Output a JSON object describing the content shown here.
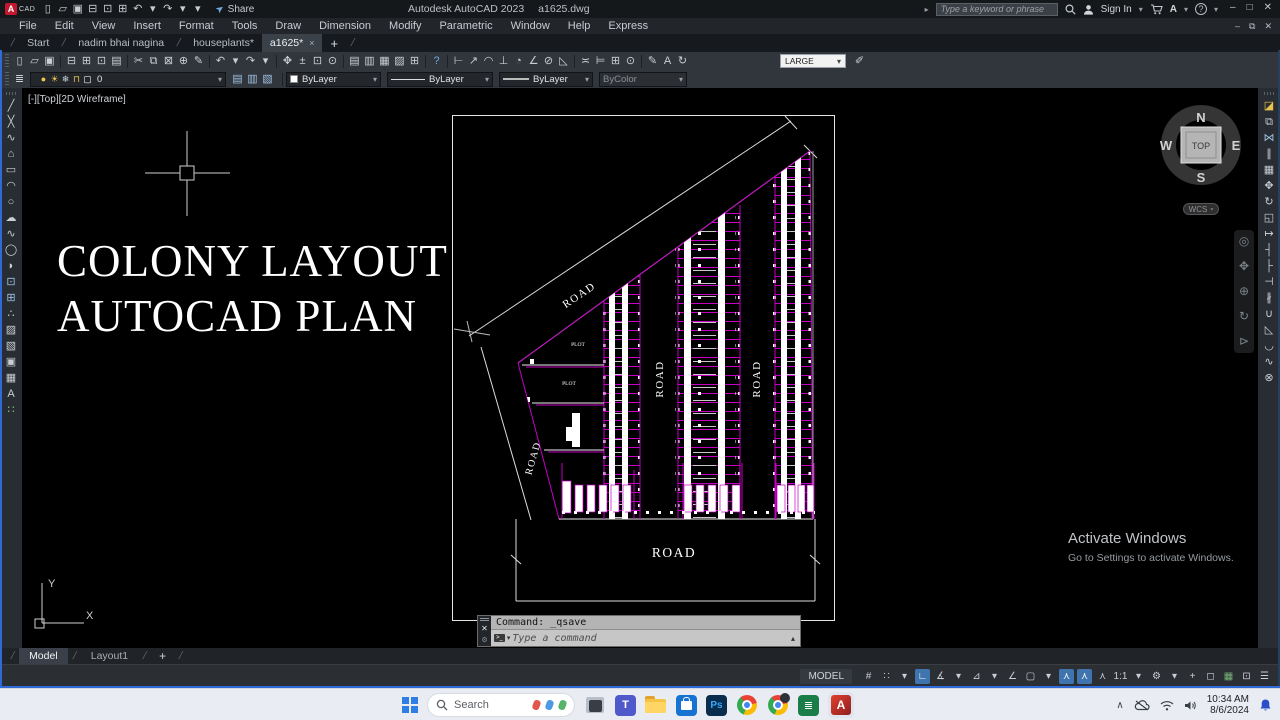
{
  "title_bar": {
    "app_title": "Autodesk AutoCAD 2023",
    "doc_title": "a1625.dwg",
    "share": "Share",
    "search_placeholder": "Type a keyword or phrase",
    "sign_in": "Sign In",
    "store_initial": "A"
  },
  "menu_bar": {
    "items": [
      "File",
      "Edit",
      "View",
      "Insert",
      "Format",
      "Tools",
      "Draw",
      "Dimension",
      "Modify",
      "Parametric",
      "Window",
      "Help",
      "Express"
    ]
  },
  "doc_tabs": {
    "tabs": [
      "Start",
      "nadim bhai nagina",
      "houseplants*",
      "a1625*"
    ],
    "close": "×",
    "add": "+"
  },
  "toolbar1": {
    "dim_style": "LARGE"
  },
  "toolbar2": {
    "layer_name": "0",
    "color": "ByLayer",
    "linetype": "ByLayer",
    "lineweight": "ByLayer",
    "plot_style": "ByColor"
  },
  "viewport_label": "[-][Top][2D Wireframe]",
  "headline": {
    "line1": "COLONY LAYOUT",
    "line2": "AUTOCAD PLAN"
  },
  "plan": {
    "road": "ROAD",
    "plot": "PLOT"
  },
  "viewcube": {
    "n": "N",
    "e": "E",
    "s": "S",
    "w": "W",
    "top": "TOP",
    "wcs": "WCS"
  },
  "ucs": {
    "x": "X",
    "y": "Y"
  },
  "command_line": {
    "history": "Command: _qsave",
    "placeholder": "Type a command"
  },
  "layout_tabs": {
    "model": "Model",
    "layout1": "Layout1",
    "add": "+"
  },
  "status_bar": {
    "model": "MODEL"
  },
  "activate": {
    "line1": "Activate Windows",
    "line2": "Go to Settings to activate Windows."
  },
  "taskbar": {
    "search": "Search",
    "time": "10:34 AM",
    "date": "8/6/2024"
  },
  "glyphs": {
    "chevron_down": "▾",
    "caret_up": "▴",
    "expander": "▸",
    "minimize": "–",
    "maximize": "□",
    "restore": "⧉",
    "close": "✕",
    "slash": "/",
    "prompt": ">_",
    "gear": "⚙",
    "question": "?",
    "help_label": "A",
    "plane": "➤",
    "chevron_up": "∧",
    "ps": "Ps",
    "teams_t": "T",
    "sheet": "≣",
    "cad": "CAD",
    "a_letter": "A",
    "dim_style_icon": "✐"
  },
  "strips": {
    "qat": [
      {
        "n": "new-file",
        "g": "▯"
      },
      {
        "n": "open-file",
        "g": "▱"
      },
      {
        "n": "save-file",
        "g": "▣"
      },
      {
        "n": "plot",
        "g": "⊟"
      },
      {
        "n": "print",
        "g": "⊡"
      },
      {
        "n": "publish",
        "g": "⊞"
      },
      {
        "n": "undo",
        "g": "↶"
      },
      {
        "n": "undo-menu",
        "g": "▾"
      },
      {
        "n": "redo",
        "g": "↷"
      },
      {
        "n": "redo-menu",
        "g": "▾"
      },
      {
        "n": "qat-customize",
        "g": "▾"
      }
    ],
    "toolbar_main": [
      {
        "n": "new-file",
        "g": "▯"
      },
      {
        "n": "open-file",
        "g": "▱"
      },
      {
        "n": "save-file",
        "g": "▣"
      },
      {
        "sep": true
      },
      {
        "n": "plot",
        "g": "⊟"
      },
      {
        "n": "plot-preview",
        "g": "⊞"
      },
      {
        "n": "print",
        "g": "⊡"
      },
      {
        "n": "publish",
        "g": "▤"
      },
      {
        "sep": true
      },
      {
        "n": "cut-clip",
        "g": "✂"
      },
      {
        "n": "copy-clip",
        "g": "⧉"
      },
      {
        "n": "paste-clip",
        "g": "⊠"
      },
      {
        "n": "copy-base-point",
        "g": "⊕"
      },
      {
        "n": "match-properties",
        "g": "✎"
      },
      {
        "sep": true
      },
      {
        "n": "undo",
        "g": "↶"
      },
      {
        "n": "undo-menu",
        "g": "▾"
      },
      {
        "n": "redo",
        "g": "↷"
      },
      {
        "n": "redo-menu",
        "g": "▾"
      },
      {
        "sep": true
      },
      {
        "n": "pan",
        "g": "✥"
      },
      {
        "n": "zoom-realtime",
        "g": "±"
      },
      {
        "n": "zoom-window",
        "g": "⊡"
      },
      {
        "n": "zoom-previous",
        "g": "⊙"
      },
      {
        "sep": true
      },
      {
        "n": "layer-properties",
        "g": "▤"
      },
      {
        "n": "layer-states",
        "g": "▥"
      },
      {
        "n": "layer-isolate",
        "g": "▦"
      },
      {
        "n": "layer-freeze",
        "g": "▨"
      },
      {
        "n": "quick-calculator",
        "g": "⊞"
      },
      {
        "sep": true
      },
      {
        "n": "help",
        "g": "?",
        "c": "#6ea8dc"
      },
      {
        "sep": true
      },
      {
        "n": "dim-linear",
        "g": "⊢"
      },
      {
        "n": "dim-aligned",
        "g": "↗"
      },
      {
        "n": "dim-arc-length",
        "g": "◠"
      },
      {
        "n": "dim-ordinate",
        "g": "⊥"
      },
      {
        "n": "dim-radius",
        "g": "◔"
      },
      {
        "n": "dim-angular",
        "g": "∠"
      },
      {
        "n": "dim-diameter",
        "g": "⊘"
      },
      {
        "n": "dim-jogged",
        "g": "◺"
      },
      {
        "sep": true
      },
      {
        "n": "dim-continue",
        "g": "≍"
      },
      {
        "n": "dim-baseline",
        "g": "⊨"
      },
      {
        "n": "tolerance",
        "g": "⊞"
      },
      {
        "n": "center-mark",
        "g": "⊙"
      },
      {
        "sep": true
      },
      {
        "n": "dim-edit",
        "g": "✎"
      },
      {
        "n": "dim-text-edit",
        "g": "A"
      },
      {
        "n": "dim-update",
        "g": "↻"
      }
    ],
    "layer_combo": [
      {
        "n": "layer-on",
        "g": "●",
        "c": "#f0c64f"
      },
      {
        "n": "layer-freeze-sun",
        "g": "☀",
        "c": "#f0c64f"
      },
      {
        "n": "layer-vp-freeze",
        "g": "❄",
        "c": "#cfd4da"
      },
      {
        "n": "layer-lock",
        "g": "⊓",
        "c": "#f0c64f"
      },
      {
        "n": "layer-color-swatch",
        "g": "▢",
        "c": "#ffffff"
      }
    ],
    "layer_tools": [
      {
        "n": "make-layer-current",
        "g": "▤",
        "c": "#9fc0e0"
      },
      {
        "n": "layer-previous",
        "g": "▥",
        "c": "#9fc0e0"
      },
      {
        "n": "layer-match",
        "g": "▧",
        "c": "#9fc0e0"
      }
    ],
    "draw_tools": [
      {
        "n": "line",
        "g": "╱"
      },
      {
        "n": "construction-line",
        "g": "╳"
      },
      {
        "n": "polyline",
        "g": "∿"
      },
      {
        "n": "polygon",
        "g": "⌂"
      },
      {
        "n": "rectangle",
        "g": "▭"
      },
      {
        "n": "arc",
        "g": "◠"
      },
      {
        "n": "circle",
        "g": "○"
      },
      {
        "n": "revision-cloud",
        "g": "☁"
      },
      {
        "n": "spline",
        "g": "∿"
      },
      {
        "n": "ellipse",
        "g": "◯"
      },
      {
        "n": "ellipse-arc",
        "g": "◗"
      },
      {
        "n": "insert-block",
        "g": "⊡",
        "c": "#9fc0e0"
      },
      {
        "n": "create-block",
        "g": "⊞",
        "c": "#9fc0e0"
      },
      {
        "n": "point",
        "g": "∴"
      },
      {
        "n": "hatch",
        "g": "▨"
      },
      {
        "n": "gradient",
        "g": "▧"
      },
      {
        "n": "region",
        "g": "▣"
      },
      {
        "n": "table",
        "g": "▦"
      },
      {
        "n": "multiline-text",
        "g": "A"
      },
      {
        "n": "point-style",
        "g": "∷",
        "c": "#7fc97f"
      }
    ],
    "modify_tools": [
      {
        "n": "erase",
        "g": "◪",
        "c": "#e8c24a"
      },
      {
        "n": "copy",
        "g": "⧉"
      },
      {
        "n": "mirror",
        "g": "⋈",
        "c": "#9fc0e0"
      },
      {
        "n": "offset",
        "g": "∥"
      },
      {
        "n": "array",
        "g": "▦"
      },
      {
        "n": "move",
        "g": "✥"
      },
      {
        "n": "rotate",
        "g": "↻"
      },
      {
        "n": "scale",
        "g": "◱"
      },
      {
        "n": "stretch",
        "g": "↦"
      },
      {
        "n": "trim",
        "g": "┤"
      },
      {
        "n": "extend",
        "g": "├"
      },
      {
        "n": "break-at-point",
        "g": "⊣"
      },
      {
        "n": "break",
        "g": "∦"
      },
      {
        "n": "join",
        "g": "∪"
      },
      {
        "n": "chamfer",
        "g": "◺"
      },
      {
        "n": "fillet",
        "g": "◡"
      },
      {
        "n": "blend-curves",
        "g": "∿"
      },
      {
        "n": "explode",
        "g": "⊗"
      }
    ],
    "navbar": [
      {
        "n": "navigation-wheel",
        "g": "◎"
      },
      {
        "n": "pan-hand",
        "g": "✥"
      },
      {
        "n": "zoom-tool",
        "g": "⊕"
      },
      {
        "n": "orbit",
        "g": "↻"
      },
      {
        "n": "show-motion",
        "g": "⊳"
      }
    ],
    "status_toggles": [
      {
        "n": "grid-display",
        "g": "#"
      },
      {
        "n": "snap-mode",
        "g": "∷"
      },
      {
        "n": "snap-menu",
        "g": "▾"
      },
      {
        "n": "ortho-mode",
        "g": "∟",
        "active": true
      },
      {
        "n": "polar-tracking",
        "g": "∡"
      },
      {
        "n": "polar-menu",
        "g": "▾"
      },
      {
        "n": "isometric-drafting",
        "g": "⊿"
      },
      {
        "n": "iso-menu",
        "g": "▾"
      },
      {
        "n": "object-snap-tracking",
        "g": "∠"
      },
      {
        "n": "object-snap",
        "g": "▢"
      },
      {
        "n": "osnap-menu",
        "g": "▾"
      },
      {
        "n": "annotation-visibility",
        "g": "⋏",
        "active": true
      },
      {
        "n": "annotation-autoscale",
        "g": "⋏",
        "active": true
      },
      {
        "n": "annotation-scale-icon",
        "g": "⋏"
      },
      {
        "n": "annotation-scale",
        "g": "1:1"
      },
      {
        "n": "scale-menu",
        "g": "▾"
      },
      {
        "n": "workspace-switching",
        "g": "⚙"
      },
      {
        "n": "workspace-menu",
        "g": "▾"
      },
      {
        "n": "annotation-monitor",
        "g": "+"
      },
      {
        "n": "isolate-objects",
        "g": "◻"
      },
      {
        "n": "graphics-performance",
        "g": "▦",
        "c": "#79b379"
      },
      {
        "n": "clean-screen",
        "g": "⊡"
      },
      {
        "n": "status-customize",
        "g": "☰"
      }
    ]
  }
}
